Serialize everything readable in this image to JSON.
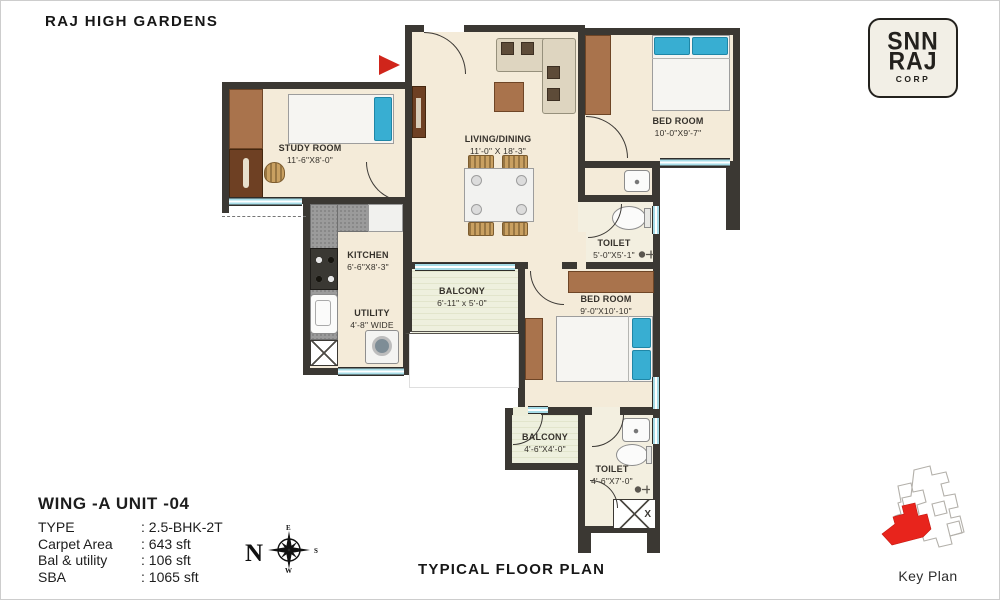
{
  "title": "RAJ HIGH GARDENS",
  "caption": "TYPICAL FLOOR PLAN",
  "logo": {
    "line1": "SNN",
    "line2": "RAJ",
    "line3": "CORP"
  },
  "plan": {
    "rooms": {
      "study": {
        "name": "STUDY ROOM",
        "dims": "11'-6\"X8'-0\""
      },
      "living": {
        "name": "LIVING/DINING",
        "dims": "11'-0\" X 18'-3\""
      },
      "bed1": {
        "name": "BED ROOM",
        "dims": "10'-0\"X9'-7\""
      },
      "kitchen": {
        "name": "KITCHEN",
        "dims": "6'-6\"X8'-3\""
      },
      "utility": {
        "name": "UTILITY",
        "dims": "4'-8\" WIDE"
      },
      "balcony1": {
        "name": "BALCONY",
        "dims": "6'-11\" x 5'-0\""
      },
      "toilet1": {
        "name": "TOILET",
        "dims": "5'-0\"X5'-1\""
      },
      "bed2": {
        "name": "BED ROOM",
        "dims": "9'-0\"X10'-10\""
      },
      "balcony2": {
        "name": "BALCONY",
        "dims": "4'-6\"X4'-0\""
      },
      "toilet2": {
        "name": "TOILET",
        "dims": "4'-6\"X7'-0\""
      },
      "shaft_label": "X"
    },
    "colors": {
      "wall": "#3b3833",
      "floor": "#f4ebd9",
      "window": "#a7dde8",
      "wood": "#a9734c",
      "pillow_blue": "#38aed2",
      "entry_arrow_red": "#d0251b"
    }
  },
  "info": {
    "unit": "WING -A  UNIT -04",
    "rows": [
      {
        "label": "TYPE",
        "value": ": 2.5-BHK-2T"
      },
      {
        "label": "Carpet Area",
        "value": ": 643 sft"
      },
      {
        "label": "Bal & utility",
        "value": ": 106 sft"
      },
      {
        "label": "SBA",
        "value": ": 1065 sft"
      }
    ]
  },
  "compass": {
    "north": "N",
    "east": "E",
    "south": "S",
    "west": "W"
  },
  "key_plan": {
    "label": "Key Plan",
    "highlight_color": "#e8241c"
  }
}
